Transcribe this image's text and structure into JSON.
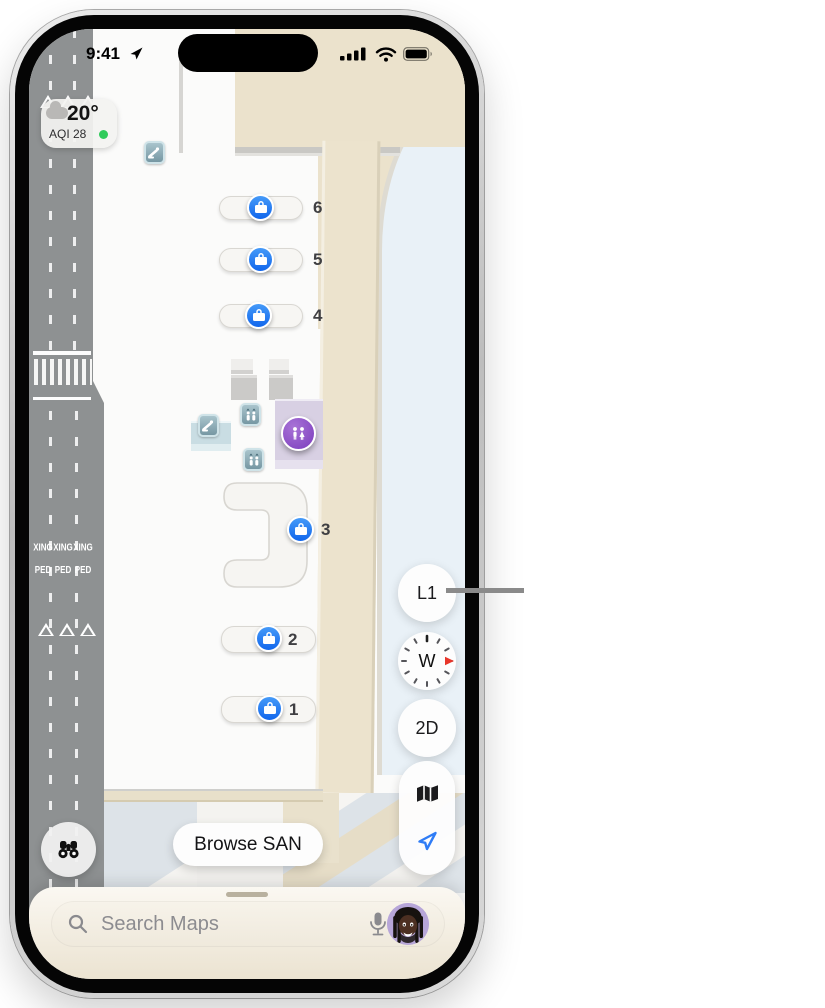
{
  "status_bar": {
    "time": "9:41"
  },
  "weather": {
    "temperature": "20°",
    "aqi": "AQI 28"
  },
  "map": {
    "road": {
      "xing": "XING",
      "ped": "PED"
    },
    "baggage_claims": [
      {
        "label": "6"
      },
      {
        "label": "5"
      },
      {
        "label": "4"
      },
      {
        "label": "3"
      },
      {
        "label": "2"
      },
      {
        "label": "1"
      }
    ]
  },
  "controls": {
    "level": "L1",
    "compass_direction": "W",
    "view_mode": "2D"
  },
  "browse": {
    "label": "Browse SAN"
  },
  "search": {
    "placeholder": "Search Maps"
  },
  "icons": {
    "status": [
      "location-arrow-icon",
      "signal-bars-icon",
      "wifi-icon",
      "battery-icon"
    ],
    "map_pois": [
      "escalator-icon",
      "elevator-icon",
      "restroom-icon",
      "baggage-claim-icon"
    ],
    "controls": [
      "compass-icon",
      "map-mode-icon",
      "track-location-icon",
      "binoculars-icon"
    ],
    "search": [
      "magnifier-icon",
      "microphone-icon",
      "memoji-avatar"
    ]
  },
  "colors": {
    "poi_blue": "#1d78f2",
    "poi_purple": "#8a4fc0",
    "poi_teal": "#86a9b4",
    "accent_blue": "#2f7cf6",
    "road_gray": "#8e9192",
    "walkway_beige": "#ebe2cc",
    "outside_blue": "#e9f1f7",
    "aqi_green": "#30cb5b",
    "compass_needle_red": "#e8362a",
    "callout_gray": "#8a8a8a"
  }
}
